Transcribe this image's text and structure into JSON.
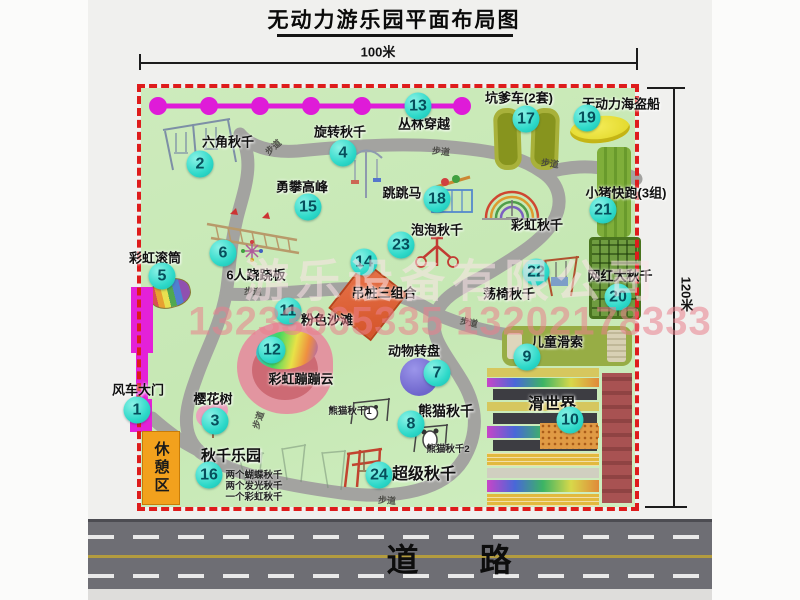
{
  "title": "无动力游乐园平面布局图",
  "dimensions": {
    "width_label": "100米",
    "height_label": "120米"
  },
  "road": {
    "label": "道 路"
  },
  "rest_area": {
    "label": "休憩区"
  },
  "watermark": {
    "company": "游乐设备有限公司",
    "phone": "13233865335 13202178333"
  },
  "path_label": "步道",
  "colors": {
    "border_dash": "#de1c1c",
    "badge": "#2ed9c9",
    "map_green": "#c9e9b8",
    "gate_magenta": "#e421d8",
    "rest_orange": "#f2a11d"
  },
  "attractions": [
    {
      "num": 1,
      "name": "风车大门",
      "lx": 138,
      "ly": 389,
      "bx": 137,
      "by": 410
    },
    {
      "num": 2,
      "name": "六角秋千",
      "lx": 228,
      "ly": 141,
      "bx": 200,
      "by": 164
    },
    {
      "num": 3,
      "name": "樱花树",
      "lx": 213,
      "ly": 398,
      "bx": 215,
      "by": 421
    },
    {
      "num": 4,
      "name": "旋转秋千",
      "lx": 340,
      "ly": 131,
      "bx": 343,
      "by": 153
    },
    {
      "num": 5,
      "name": "彩虹滚筒",
      "lx": 155,
      "ly": 257,
      "bx": 162,
      "by": 276
    },
    {
      "num": 6,
      "name": "6人跷跷板",
      "lx": 256,
      "ly": 274,
      "bx": 223,
      "by": 253
    },
    {
      "num": 7,
      "name": "动物转盘",
      "lx": 414,
      "ly": 350,
      "bx": 437,
      "by": 373
    },
    {
      "num": 8,
      "name": "熊猫秋千",
      "lx": 446,
      "ly": 411,
      "fs": 14,
      "bx": 411,
      "by": 424
    },
    {
      "num": 9,
      "name": "儿童滑索",
      "lx": 557,
      "ly": 341,
      "bx": 527,
      "by": 357
    },
    {
      "num": 10,
      "name": "滑世界",
      "lx": 552,
      "ly": 402,
      "fs": 16,
      "bx": 570,
      "by": 420
    },
    {
      "num": 11,
      "name": "粉色沙滩",
      "lx": 327,
      "ly": 319,
      "bx": 288,
      "by": 311
    },
    {
      "num": 12,
      "name": "彩虹蹦蹦云",
      "lx": 301,
      "ly": 378,
      "bx": 272,
      "by": 350
    },
    {
      "num": 13,
      "name": "丛林穿越",
      "lx": 424,
      "ly": 123,
      "bx": 418,
      "by": 106
    },
    {
      "num": 14,
      "name": "吊桩三组合",
      "lx": 384,
      "ly": 292,
      "bx": 364,
      "by": 262
    },
    {
      "num": 15,
      "name": "勇攀高峰",
      "lx": 302,
      "ly": 186,
      "bx": 308,
      "by": 207
    },
    {
      "num": 16,
      "name": "秋千乐园",
      "lx": 231,
      "ly": 455,
      "fs": 15,
      "bx": 209,
      "by": 475
    },
    {
      "num": 17,
      "name": "坑爹车(2套)",
      "lx": 519,
      "ly": 97,
      "bx": 526,
      "by": 119
    },
    {
      "num": 18,
      "name": "跳跳马",
      "lx": 402,
      "ly": 192,
      "bx": 437,
      "by": 199
    },
    {
      "num": 19,
      "name": "无动力海盗船",
      "lx": 621,
      "ly": 103,
      "bx": 587,
      "by": 118
    },
    {
      "num": 20,
      "name": "网红大秋千",
      "lx": 620,
      "ly": 275,
      "bx": 618,
      "by": 297
    },
    {
      "num": 21,
      "name": "小猪快跑(3组)",
      "lx": 626,
      "ly": 192,
      "bx": 603,
      "by": 210
    },
    {
      "num": 22,
      "name": "荡椅秋千",
      "lx": 509,
      "ly": 293,
      "bx": 536,
      "by": 272
    },
    {
      "num": 23,
      "name": "泡泡秋千",
      "lx": 437,
      "ly": 229,
      "bx": 401,
      "by": 245
    },
    {
      "num": 24,
      "name": "超级秋千",
      "lx": 424,
      "ly": 472,
      "fs": 16,
      "bx": 379,
      "by": 475
    },
    {
      "name": "彩虹秋千",
      "lx": 537,
      "ly": 224
    }
  ],
  "extra_labels": {
    "panda1": "熊猫秋千1",
    "panda2": "熊猫秋千2",
    "swing_park_lines": [
      "两个蝴蝶秋千",
      "两个发光秋千",
      "一个彩虹秋千"
    ]
  },
  "path_labels": [
    {
      "x": 273,
      "y": 147,
      "r": -42
    },
    {
      "x": 441,
      "y": 151,
      "r": 6
    },
    {
      "x": 550,
      "y": 163,
      "r": 8
    },
    {
      "x": 253,
      "y": 291,
      "r": 3
    },
    {
      "x": 469,
      "y": 322,
      "r": 12
    },
    {
      "x": 258,
      "y": 420,
      "r": -72
    },
    {
      "x": 387,
      "y": 500,
      "r": 4
    }
  ]
}
